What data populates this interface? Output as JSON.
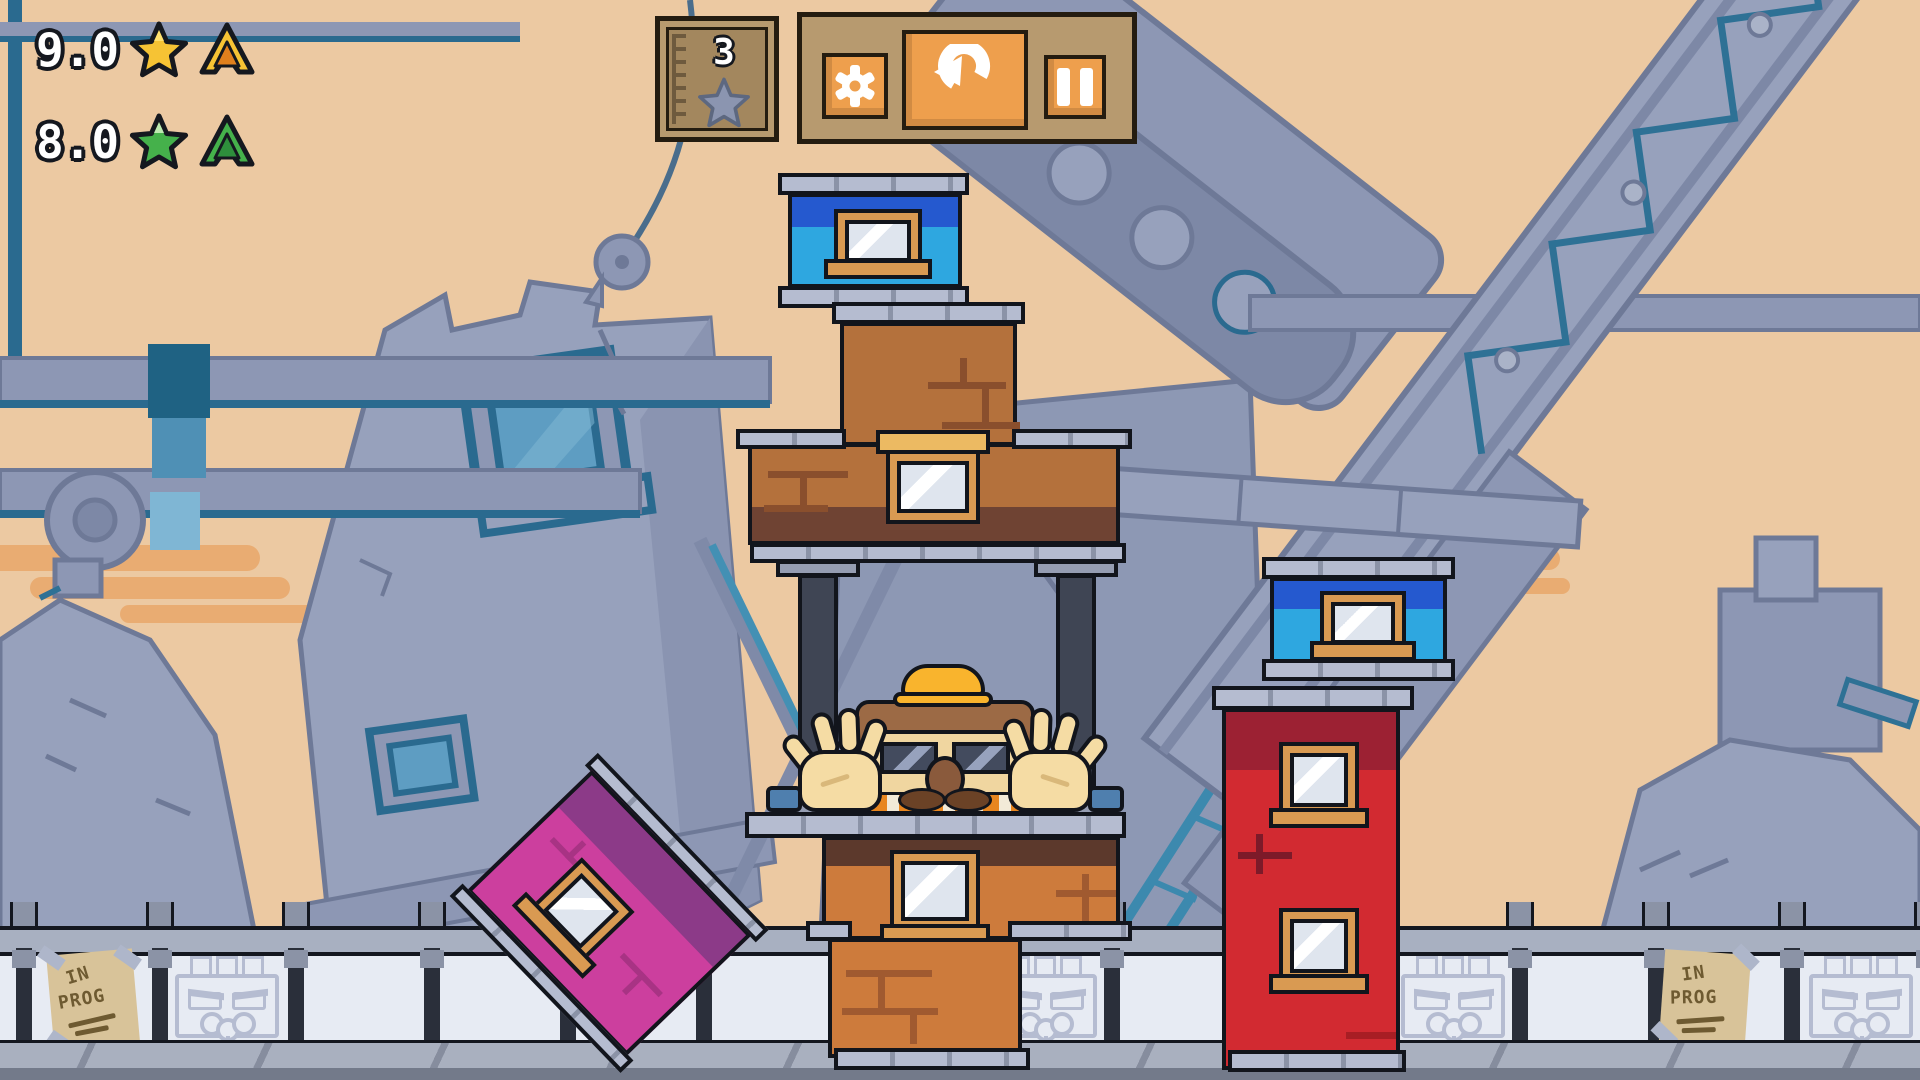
{
  "hud": {
    "gold": {
      "value": "9.0",
      "star_color": "#f6c334",
      "arrow_outer": "#f6c334",
      "arrow_inner": "#e0801d"
    },
    "green": {
      "value": "8.0",
      "star_color": "#45b14b",
      "arrow_outer": "#45b14b",
      "arrow_inner": "#2e8f3c"
    }
  },
  "height_meter": {
    "value": "3",
    "star_color": "#8b95b0"
  },
  "toolbar": {
    "buttons": [
      {
        "name": "settings",
        "icon": "gear-icon"
      },
      {
        "name": "restart",
        "icon": "rotate-ccw-icon"
      },
      {
        "name": "pause",
        "icon": "pause-icon"
      }
    ],
    "button_color": "#ee9f4d",
    "panel_color": "#b79a6f"
  },
  "fence": {
    "poster": {
      "line1": "IN",
      "line2": "PROG"
    },
    "panel_pattern": [
      "poster",
      "face",
      "empty",
      "covered",
      "covered",
      "covered",
      "covered",
      "face",
      "empty",
      "covered",
      "face",
      "empty",
      "poster",
      "face"
    ]
  },
  "blocks": [
    {
      "name": "blue-roof-center",
      "body": "#2ea7e0",
      "band": "#2559cf",
      "window": true
    },
    {
      "name": "brown-brick-upper",
      "body": "#b4713c",
      "band": "#6f4333",
      "window": true
    },
    {
      "name": "steel-floor-with-pillars",
      "body": "#3f4554"
    },
    {
      "name": "brown-brick-base",
      "body": "#cd7b3c",
      "band": "#5c392c",
      "window": true
    },
    {
      "name": "pink-tilted",
      "body": "#cc3f9e",
      "band": "#8c3a88",
      "window": true,
      "rotation_deg": 46
    },
    {
      "name": "red-tower",
      "body": "#d22a31",
      "band": "#9c2133",
      "windows": 2
    },
    {
      "name": "blue-roof-right",
      "body": "#2ea7e0",
      "band": "#2559cf",
      "window": true
    }
  ],
  "character": {
    "type": "construction-worker",
    "hat": "#f9b42d",
    "pose": "hands-up"
  },
  "colors": {
    "sky": "#ecc9a2",
    "structures": "#97a1bc",
    "structure_accent": "#2e7195",
    "fence_panel": "#e7ebf3",
    "cap_gray": "#b5bcd0",
    "window_frame": "#d99a52"
  }
}
